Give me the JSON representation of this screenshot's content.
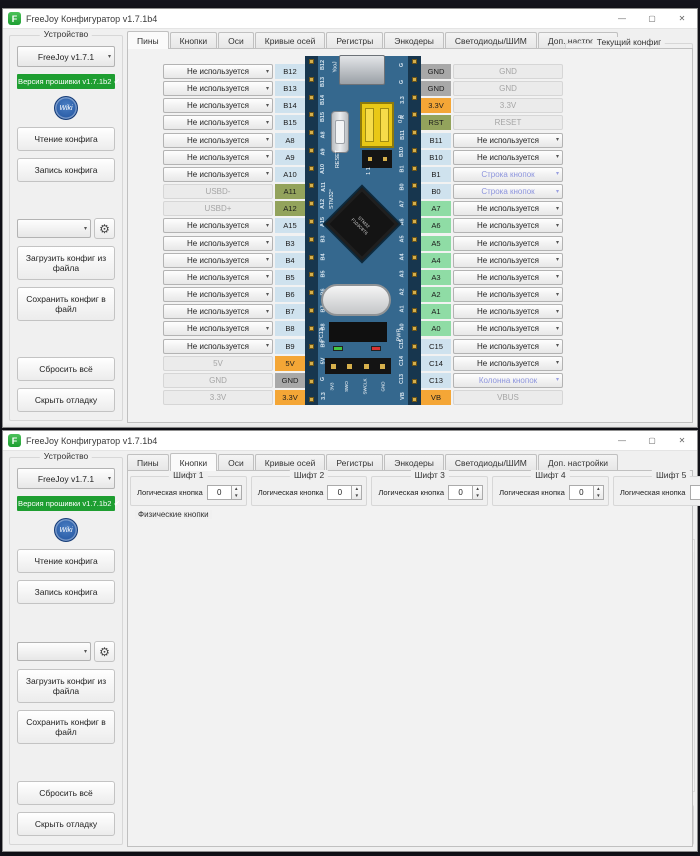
{
  "app_icon_letter": "F",
  "titlebar": {
    "title": "FreeJoy Конфигуратор v1.7.1b4"
  },
  "window_controls": {
    "minimize": "—",
    "maximize": "▢",
    "close": "✕"
  },
  "icons": {
    "dropdown_arrow": "▾",
    "spin_up": "▲",
    "spin_down": "▼",
    "gear": "⚙",
    "scroll_up": "▲",
    "scroll_down": "▼",
    "info": "ⓘ"
  },
  "tabs": [
    "Пины",
    "Кнопки",
    "Оси",
    "Кривые осей",
    "Регистры",
    "Энкодеры",
    "Светодиоды/ШИМ",
    "Доп. настройки"
  ],
  "sidebar": {
    "group_title": "Устройство",
    "device_select": "FreeJoy v1.7.1",
    "firmware_badge": "Версия прошивки v1.7.1b2 ✔",
    "wiki_label": "Wiki",
    "read_button": "Чтение конфига",
    "write_button": "Запись конфига",
    "preset_select": "",
    "load_button": "Загрузить конфиг из файла",
    "save_button": "Сохранить конфиг в файл",
    "reset_button": "Сбросить всё",
    "debug_button": "Скрыть отладку"
  },
  "pins_tab": {
    "active_tab": "Пины",
    "pins_left": [
      {
        "pin": "B12",
        "value": "Не используется",
        "kind": "select",
        "badge": "blue"
      },
      {
        "pin": "B13",
        "value": "Не используется",
        "kind": "select",
        "badge": "blue"
      },
      {
        "pin": "B14",
        "value": "Не используется",
        "kind": "select",
        "badge": "blue"
      },
      {
        "pin": "B15",
        "value": "Не используется",
        "kind": "select",
        "badge": "blue"
      },
      {
        "pin": "A8",
        "value": "Не используется",
        "kind": "select",
        "badge": "blue"
      },
      {
        "pin": "A9",
        "value": "Не используется",
        "kind": "select",
        "badge": "blue"
      },
      {
        "pin": "A10",
        "value": "Не используется",
        "kind": "select",
        "badge": "blue"
      },
      {
        "pin": "A11",
        "value": "USBD-",
        "kind": "static",
        "badge": "olive"
      },
      {
        "pin": "A12",
        "value": "USBD+",
        "kind": "static",
        "badge": "olive"
      },
      {
        "pin": "A15",
        "value": "Не используется",
        "kind": "select",
        "badge": "blue"
      },
      {
        "pin": "B3",
        "value": "Не используется",
        "kind": "select",
        "badge": "blue"
      },
      {
        "pin": "B4",
        "value": "Не используется",
        "kind": "select",
        "badge": "blue"
      },
      {
        "pin": "B5",
        "value": "Не используется",
        "kind": "select",
        "badge": "blue"
      },
      {
        "pin": "B6",
        "value": "Не используется",
        "kind": "select",
        "badge": "blue"
      },
      {
        "pin": "B7",
        "value": "Не используется",
        "kind": "select",
        "badge": "blue"
      },
      {
        "pin": "B8",
        "value": "Не используется",
        "kind": "select",
        "badge": "blue"
      },
      {
        "pin": "B9",
        "value": "Не используется",
        "kind": "select",
        "badge": "blue"
      },
      {
        "pin": "5V",
        "value": "5V",
        "kind": "static",
        "badge": "orange"
      },
      {
        "pin": "GND",
        "value": "GND",
        "kind": "static",
        "badge": "gray"
      },
      {
        "pin": "3.3V",
        "value": "3.3V",
        "kind": "static",
        "badge": "orange"
      }
    ],
    "pins_right": [
      {
        "pin": "GND",
        "value": "GND",
        "kind": "static",
        "badge": "gray"
      },
      {
        "pin": "GND",
        "value": "GND",
        "kind": "static",
        "badge": "gray"
      },
      {
        "pin": "3.3V",
        "value": "3.3V",
        "kind": "static",
        "badge": "orange"
      },
      {
        "pin": "RST",
        "value": "RESET",
        "kind": "static",
        "badge": "olive"
      },
      {
        "pin": "B11",
        "value": "Не используется",
        "kind": "select",
        "badge": "blue"
      },
      {
        "pin": "B10",
        "value": "Не используется",
        "kind": "select",
        "badge": "blue"
      },
      {
        "pin": "B1",
        "value": "Строка кнопок",
        "kind": "colored",
        "badge": "blue"
      },
      {
        "pin": "B0",
        "value": "Строка кнопок",
        "kind": "colored",
        "badge": "blue"
      },
      {
        "pin": "A7",
        "value": "Не используется",
        "kind": "select",
        "badge": "green"
      },
      {
        "pin": "A6",
        "value": "Не используется",
        "kind": "select",
        "badge": "green"
      },
      {
        "pin": "A5",
        "value": "Не используется",
        "kind": "select",
        "badge": "green"
      },
      {
        "pin": "A4",
        "value": "Не используется",
        "kind": "select",
        "badge": "green"
      },
      {
        "pin": "A3",
        "value": "Не используется",
        "kind": "select",
        "badge": "green"
      },
      {
        "pin": "A2",
        "value": "Не используется",
        "kind": "select",
        "badge": "green"
      },
      {
        "pin": "A1",
        "value": "Не используется",
        "kind": "select",
        "badge": "green"
      },
      {
        "pin": "A0",
        "value": "Не используется",
        "kind": "select",
        "badge": "green"
      },
      {
        "pin": "C15",
        "value": "Не используется",
        "kind": "select",
        "badge": "blue"
      },
      {
        "pin": "C14",
        "value": "Не используется",
        "kind": "select",
        "badge": "blue"
      },
      {
        "pin": "C13",
        "value": "Колонна кнопок",
        "kind": "colored",
        "badge": "blue"
      },
      {
        "pin": "VB",
        "value": "VBUS",
        "kind": "static",
        "badge": "orange"
      }
    ],
    "board": {
      "left_silk": [
        "B12",
        "B13",
        "B14",
        "B15",
        "A8",
        "A9",
        "A10",
        "A11",
        "A12",
        "A15",
        "B3",
        "B4",
        "B5",
        "B6",
        "B7",
        "B8",
        "B9",
        "5V",
        "G",
        "3.3"
      ],
      "right_silk": [
        "G",
        "G",
        "3.3",
        "R",
        "B11",
        "B10",
        "B1",
        "B0",
        "A7",
        "A6",
        "A5",
        "A4",
        "A3",
        "A2",
        "A1",
        "A0",
        "C15",
        "C14",
        "C13",
        "VB"
      ],
      "texts": {
        "usb_silk": "YooJ",
        "reset": "RESET",
        "stm": "STM32°",
        "chip1": "STM32",
        "chip2": "F103C8T6",
        "boot_top": "0  0",
        "boot_bottom": "1  1",
        "pc13": "PC13",
        "pwr": "PWR",
        "swd": [
          "3V3",
          "SWO",
          "SWCLK",
          "GND"
        ]
      }
    },
    "config_panel": {
      "title": "Текущий конфиг",
      "items": [
        {
          "label": "Источников осей:",
          "value": "0"
        },
        {
          "label": "Кнопок из осей:",
          "value": "0"
        },
        {
          "label": "Кнопок у регистров:",
          "value": "0"
        },
        {
          "label": "Рядов кнопок:",
          "value": "2"
        },
        {
          "label": "Колонн кнопок:",
          "value": "1"
        },
        {
          "label": "Кнопок из матрицы:",
          "value": "2"
        },
        {
          "label": "Одиночных кнопок:",
          "value": "0"
        },
        {
          "label": "Всего кнопок:",
          "value": "2"
        },
        {
          "label": "Всего светодиодов:",
          "value": "0"
        }
      ]
    },
    "board_select": {
      "label": "Выбор платы",
      "value": "Blue Pill"
    }
  },
  "buttons_tab": {
    "active_tab": "Кнопки",
    "shifts": [
      {
        "title": "Шифт 1",
        "label": "Логическая кнопка",
        "value": "0"
      },
      {
        "title": "Шифт 2",
        "label": "Логическая кнопка",
        "value": "0"
      },
      {
        "title": "Шифт 3",
        "label": "Логическая кнопка",
        "value": "0"
      },
      {
        "title": "Шифт 4",
        "label": "Логическая кнопка",
        "value": "0"
      },
      {
        "title": "Шифт 5",
        "label": "Логическая кнопка",
        "value": "0"
      }
    ],
    "physical": {
      "title": "Физические кнопки",
      "buttons": [
        {
          "num": "1",
          "color": "#a83434"
        },
        {
          "num": "2",
          "color": "#2f9e3d"
        }
      ]
    },
    "logical": {
      "title": "Логические кнопки",
      "auto_label": "Автоматически устанавливать физическую кнопку при нажатии",
      "headers": [
        "№",
        "Физич",
        "Выкл",
        "Инверт",
        "Функция",
        "Шифт",
        "Таймер задержки",
        "Время нажатия"
      ],
      "rows": [
        {
          "n": "1",
          "phys": "1",
          "off": false,
          "invert": false,
          "func": "Обычная кнопка",
          "shift": "-",
          "delay": "-",
          "press": "-",
          "state": "normal"
        },
        {
          "n": "2",
          "phys": "2",
          "off": true,
          "invert": true,
          "func": "Обычная кнопка",
          "shift": "-",
          "delay": "-",
          "press": "-",
          "state": "selected"
        },
        {
          "n": "3",
          "phys": "0",
          "off": false,
          "invert": false,
          "func": "Обычная кнопка",
          "shift": "-",
          "delay": "-",
          "press": "-",
          "state": "disabled"
        },
        {
          "n": "4",
          "phys": "0",
          "off": false,
          "invert": false,
          "func": "Обычная кнопка",
          "shift": "-",
          "delay": "-",
          "press": "-",
          "state": "disabled"
        },
        {
          "n": "5",
          "phys": "0",
          "off": false,
          "invert": false,
          "func": "Обычная кнопка",
          "shift": "-",
          "delay": "-",
          "press": "-",
          "state": "disabled"
        },
        {
          "n": "6",
          "phys": "0",
          "off": false,
          "invert": false,
          "func": "Обычная кнопка",
          "shift": "-",
          "delay": "-",
          "press": "-",
          "state": "disabled"
        },
        {
          "n": "7",
          "phys": "0",
          "off": false,
          "invert": false,
          "func": "Обычная кнопка",
          "shift": "-",
          "delay": "-",
          "press": "-",
          "state": "disabled"
        },
        {
          "n": "8",
          "phys": "0",
          "off": false,
          "invert": false,
          "func": "Обычная кнопка",
          "shift": "-",
          "delay": "-",
          "press": "-",
          "state": "disabled"
        },
        {
          "n": "9",
          "phys": "0",
          "off": false,
          "invert": false,
          "func": "Обычная кнопка",
          "shift": "-",
          "delay": "-",
          "press": "-",
          "state": "disabled"
        },
        {
          "n": "10",
          "phys": "0",
          "off": false,
          "invert": false,
          "func": "Обычная кнопка",
          "shift": "-",
          "delay": "-",
          "press": "-",
          "state": "disabled"
        },
        {
          "n": "11",
          "phys": "0",
          "off": false,
          "invert": false,
          "func": "Обычная кнопка",
          "shift": "-",
          "delay": "-",
          "press": "-",
          "state": "disabled"
        },
        {
          "n": "12",
          "phys": "0",
          "off": false,
          "invert": false,
          "func": "Обычная кнопка",
          "shift": "-",
          "delay": "-",
          "press": "-",
          "state": "disabled"
        },
        {
          "n": "13",
          "phys": "0",
          "off": false,
          "invert": false,
          "func": "Обычная кнопка",
          "shift": "-",
          "delay": "-",
          "press": "-",
          "state": "disabled"
        },
        {
          "n": "14",
          "phys": "0",
          "off": false,
          "invert": false,
          "func": "Обычная кнопка",
          "shift": "-",
          "delay": "-",
          "press": "-",
          "state": "disabled"
        },
        {
          "n": "15",
          "phys": "0",
          "off": false,
          "invert": false,
          "func": "Обычная кнопка",
          "shift": "-",
          "delay": "-",
          "press": "-",
          "state": "disabled"
        }
      ]
    },
    "timers": {
      "title": "Настройки таймеров",
      "unit": "мс",
      "items": [
        {
          "label": "Таймер 1",
          "value": "50"
        },
        {
          "label": "Таймер 2",
          "value": "200"
        },
        {
          "label": "Таймер 3",
          "value": "300"
        },
        {
          "label": "Таймер дребезга",
          "value": "50"
        },
        {
          "label": "Оси в кнопки таймер",
          "value": "50"
        },
        {
          "label": "Время нажатия энкодера",
          "value": "30"
        }
      ]
    }
  },
  "colors": {
    "accent_green": "#1e9e31",
    "selected_row_green": "#21a038",
    "badge_blue": "#cfe2ee",
    "badge_green": "#8fdca5",
    "badge_olive": "#93a35c",
    "badge_orange": "#f4a636",
    "badge_gray": "#a8a8a8",
    "colored_option_text": "#8d95dd",
    "physical_btn_red": "#a83434",
    "physical_btn_green": "#2f9e3d",
    "board_blue": "#35688e"
  }
}
